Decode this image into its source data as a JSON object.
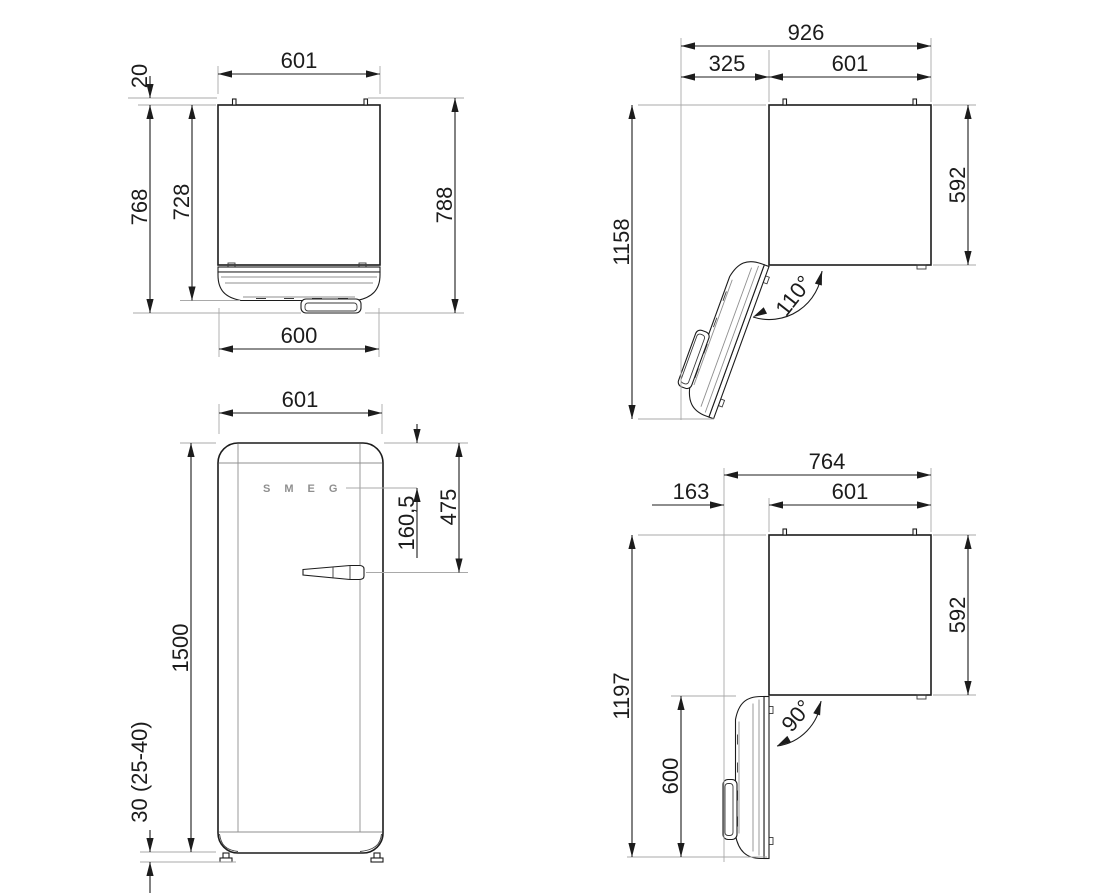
{
  "drawing": {
    "title": "refrigerator-dimension-drawing",
    "logo": "SMEG",
    "colors": {
      "line": "#1c1c1c",
      "extension": "#a9a9a9",
      "background": "#ffffff"
    },
    "views": {
      "plan": {
        "width": "601",
        "pin_offset": "20",
        "depth_body": "728",
        "depth_handle": "768",
        "depth_total": "788",
        "door_width": "600"
      },
      "front": {
        "width": "601",
        "height": "1500",
        "feet_height": "30 (25-40)",
        "logo_offset": "160,5",
        "handle_offset": "475"
      },
      "open110": {
        "total_width": "926",
        "door_swing": "325",
        "width": "601",
        "total_depth": "1158",
        "body_depth": "592",
        "angle": "110°"
      },
      "open90": {
        "total_width": "764",
        "handle_clearance": "163",
        "width": "601",
        "total_depth": "1197",
        "body_depth": "592",
        "door_depth": "600",
        "angle": "90°"
      }
    }
  }
}
